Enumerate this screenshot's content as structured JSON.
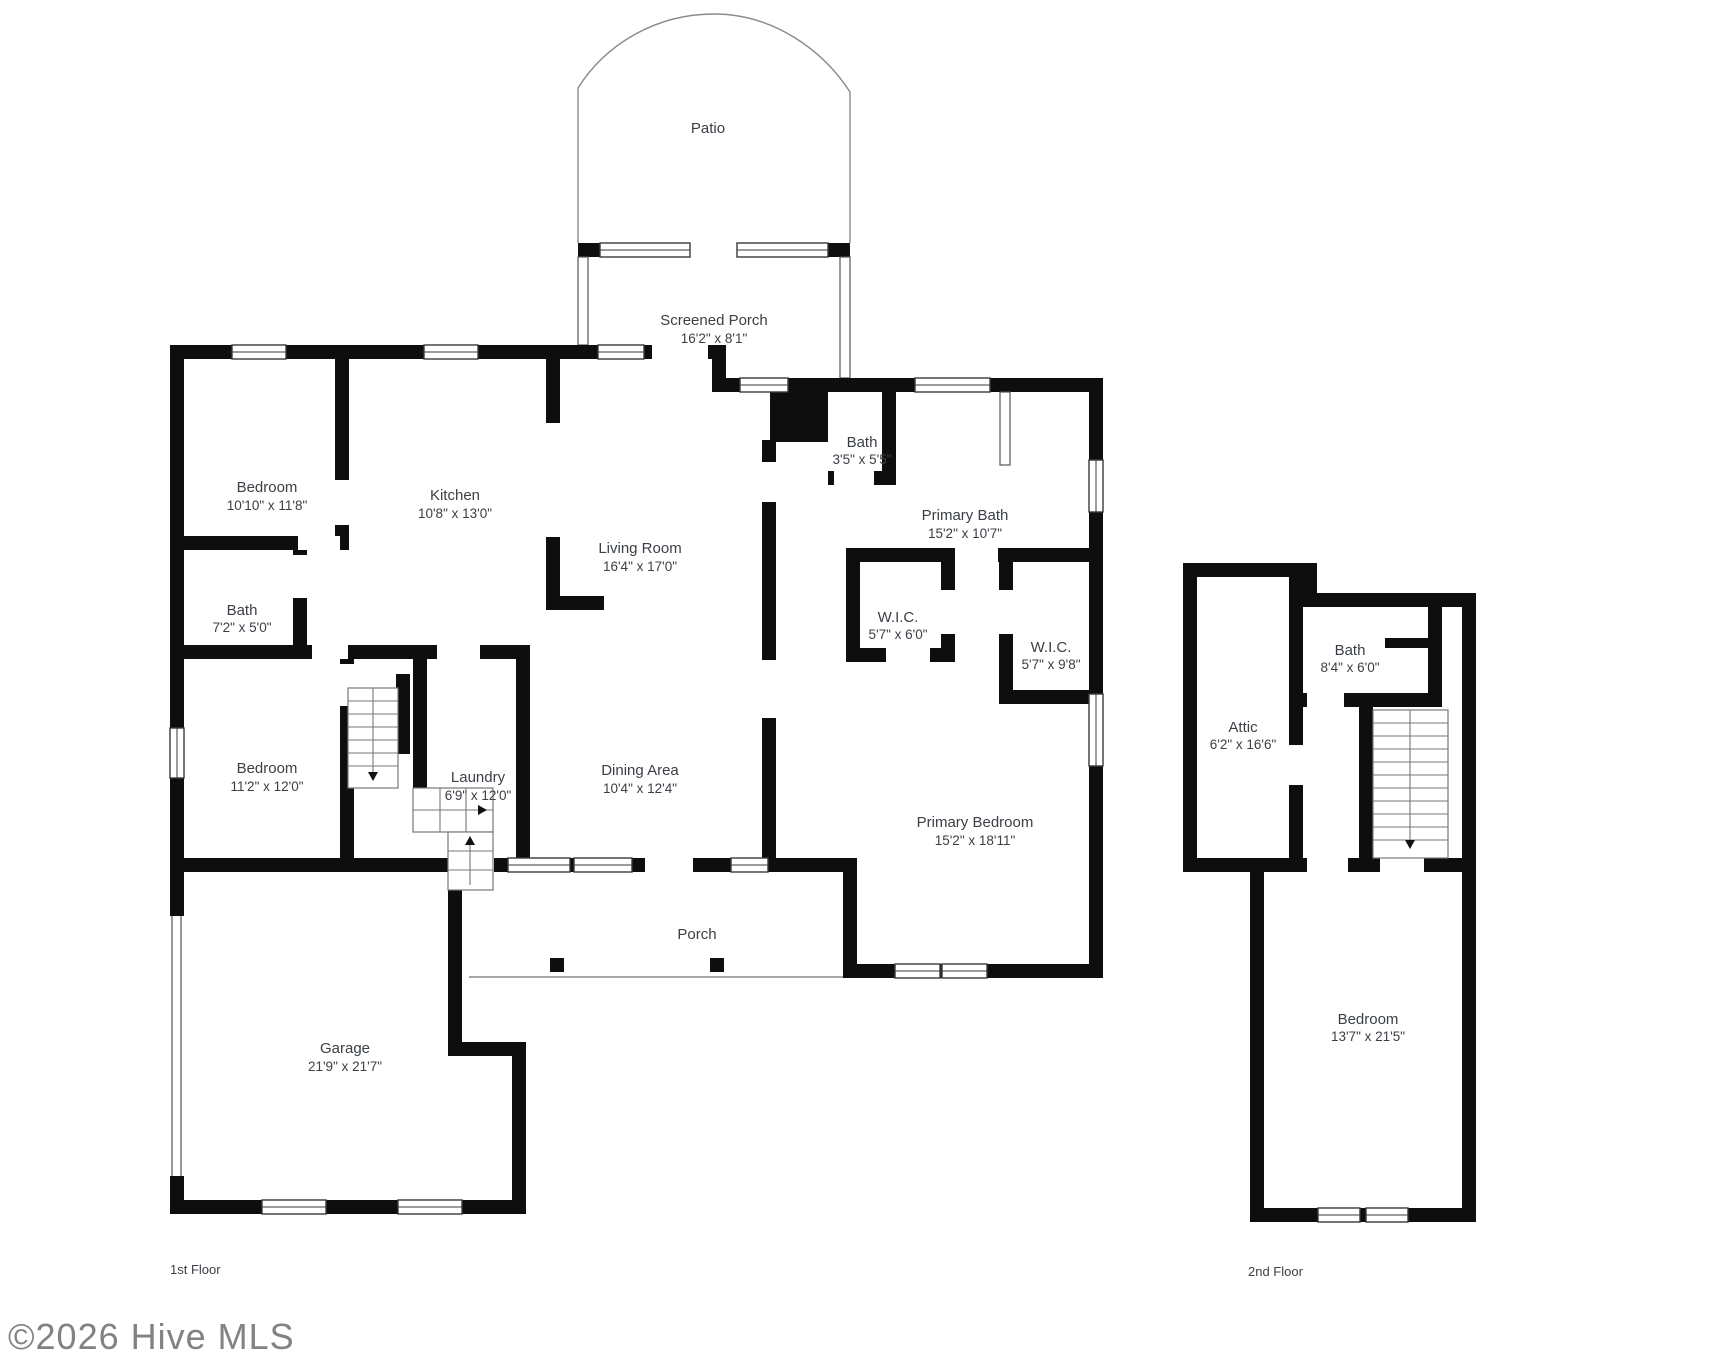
{
  "watermark": "©2026 Hive MLS",
  "colors": {
    "wall": "#0e0e0e",
    "text": "#3b4046",
    "thin_line": "#8a8a8a",
    "watermark": "#828282"
  },
  "first_floor": {
    "label": "1st Floor",
    "outdoor": {
      "patio": {
        "name": "Patio"
      },
      "screened_porch": {
        "name": "Screened Porch",
        "dims": "16'2\" x 8'1\""
      },
      "porch": {
        "name": "Porch"
      }
    },
    "rooms": {
      "bedroom1": {
        "name": "Bedroom",
        "dims": "10'10\" x 11'8\""
      },
      "kitchen": {
        "name": "Kitchen",
        "dims": "10'8\" x 13'0\""
      },
      "living_room": {
        "name": "Living Room",
        "dims": "16'4\" x 17'0\""
      },
      "bath_small": {
        "name": "Bath",
        "dims": "3'5\" x 5'5\""
      },
      "primary_bath": {
        "name": "Primary Bath",
        "dims": "15'2\" x 10'7\""
      },
      "bath": {
        "name": "Bath",
        "dims": "7'2\" x 5'0\""
      },
      "wic1": {
        "name": "W.I.C.",
        "dims": "5'7\" x 6'0\""
      },
      "wic2": {
        "name": "W.I.C.",
        "dims": "5'7\" x 9'8\""
      },
      "bedroom2": {
        "name": "Bedroom",
        "dims": "11'2\" x 12'0\""
      },
      "laundry": {
        "name": "Laundry",
        "dims": "6'9\" x 12'0\""
      },
      "dining": {
        "name": "Dining Area",
        "dims": "10'4\" x 12'4\""
      },
      "primary_bedroom": {
        "name": "Primary Bedroom",
        "dims": "15'2\" x 18'11\""
      },
      "garage": {
        "name": "Garage",
        "dims": "21'9\" x 21'7\""
      }
    }
  },
  "second_floor": {
    "label": "2nd Floor",
    "rooms": {
      "attic": {
        "name": "Attic",
        "dims": "6'2\" x 16'6\""
      },
      "bath": {
        "name": "Bath",
        "dims": "8'4\" x 6'0\""
      },
      "bedroom": {
        "name": "Bedroom",
        "dims": "13'7\" x 21'5\""
      }
    }
  }
}
